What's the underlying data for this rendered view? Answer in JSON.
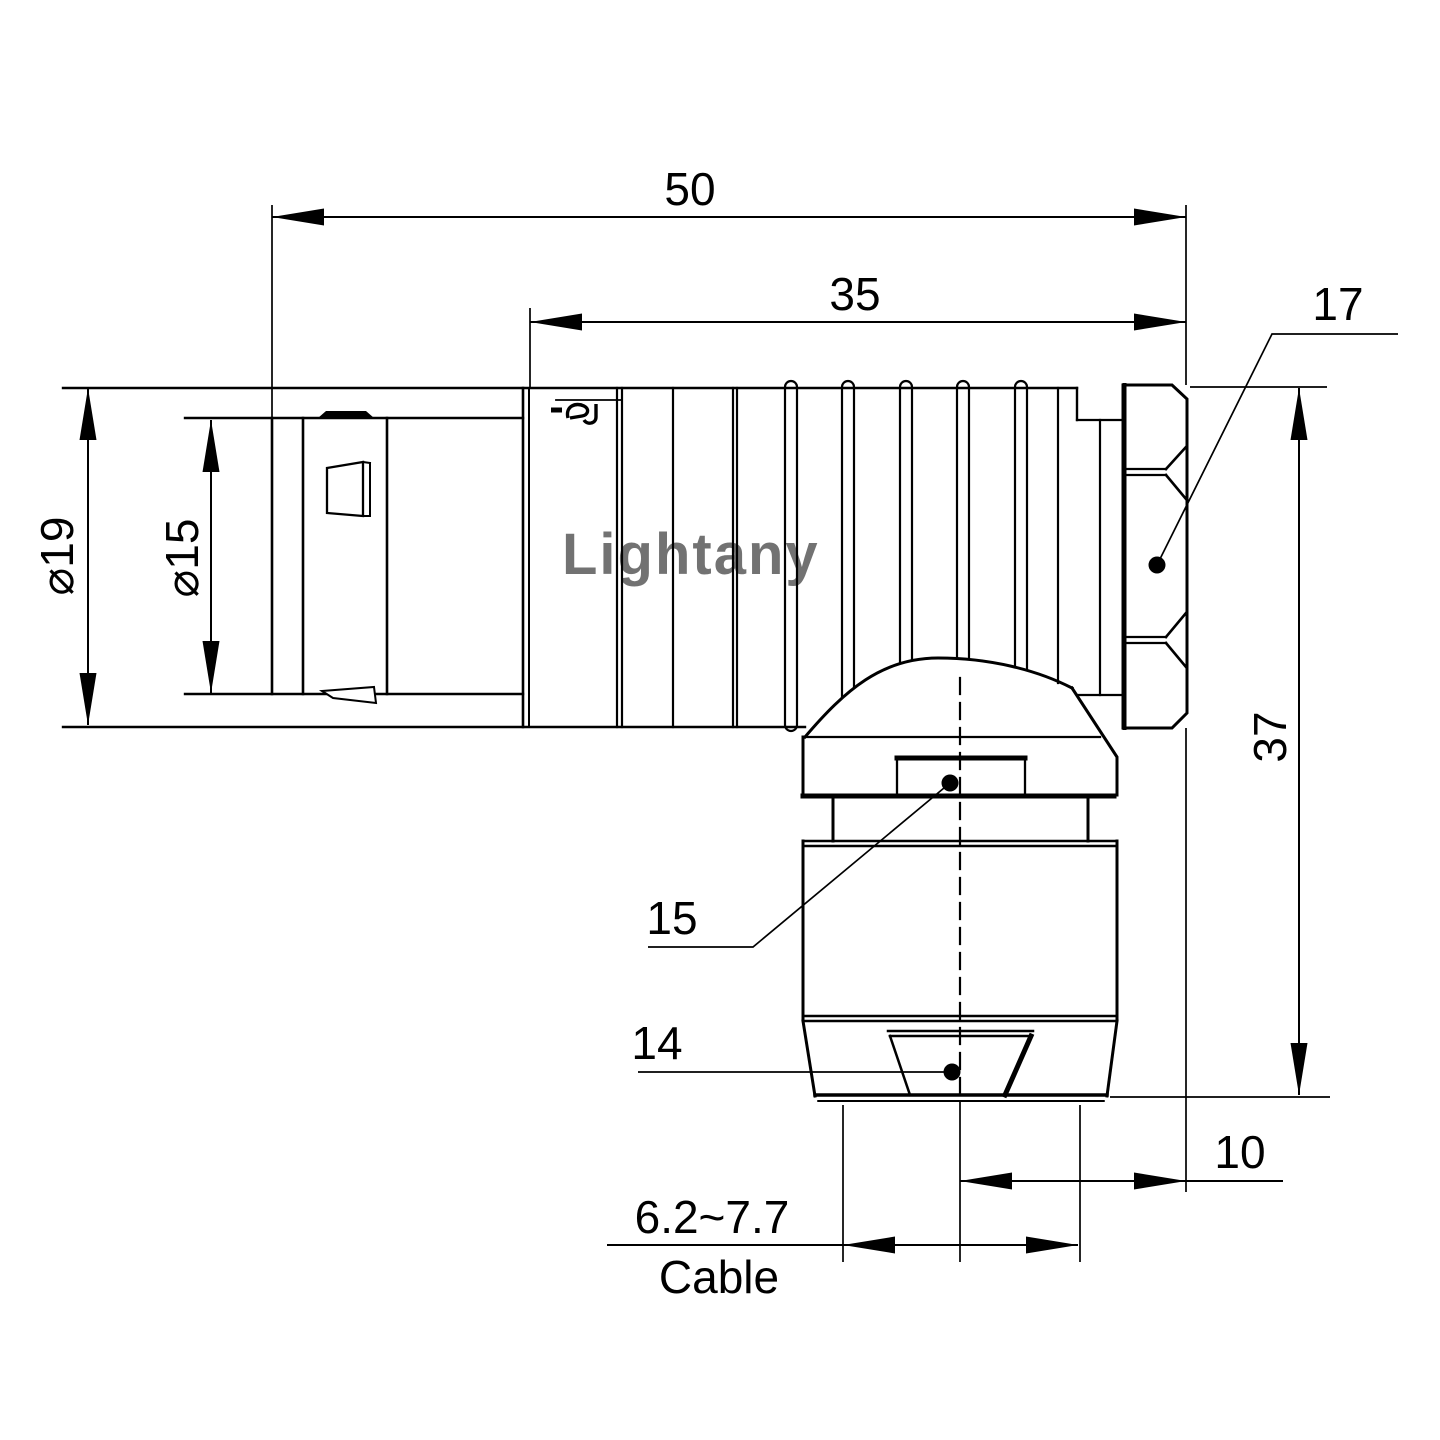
{
  "drawing": {
    "watermark": {
      "text": "Lightany",
      "color": "#f0aebc"
    },
    "colors": {
      "ink": "#000000",
      "background": "#ffffff"
    },
    "dimensions": {
      "overall_length": "50",
      "body_length": "35",
      "hex_across_flats": "17",
      "outer_diameter": "⌀19",
      "coupling_diameter": "⌀15",
      "height": "37",
      "elbow_width": "15",
      "clamp_nut": "14",
      "offset": "10",
      "cable_range": "6.2~7.7",
      "cable_caption": "Cable"
    }
  }
}
